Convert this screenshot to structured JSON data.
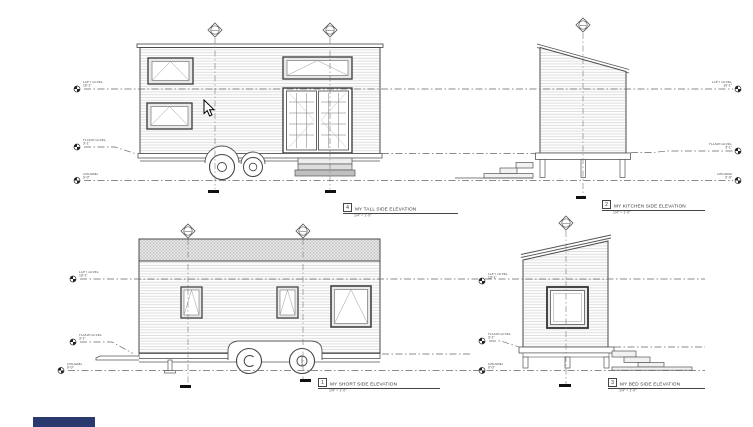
{
  "levels": {
    "loft": {
      "label": "LOFT LEVEL",
      "value": "10'-1\""
    },
    "floor": {
      "label": "FLOOR LEVEL",
      "value": "3'-1\""
    },
    "ground": {
      "label": "GROUND",
      "value": "0'-0\""
    }
  },
  "views": {
    "tall": {
      "num": "4",
      "title": "MY TALL SIDE ELEVATION",
      "scale": "1/4\" = 1'-0\""
    },
    "kitchen": {
      "num": "2",
      "title": "MY KITCHEN SIDE ELEVATION",
      "scale": "1/4\" = 1'-0\""
    },
    "short": {
      "num": "1",
      "title": "MY SHORT SIDE ELEVATION",
      "scale": "1/4\" = 1'-0\""
    },
    "bed": {
      "num": "3",
      "title": "MY BED SIDE ELEVATION",
      "scale": "1/4\" = 1'-0\""
    }
  },
  "cursor": {
    "glyph": "arrow-pointer"
  },
  "accent_bar": {
    "color": "#2b3a6e"
  }
}
